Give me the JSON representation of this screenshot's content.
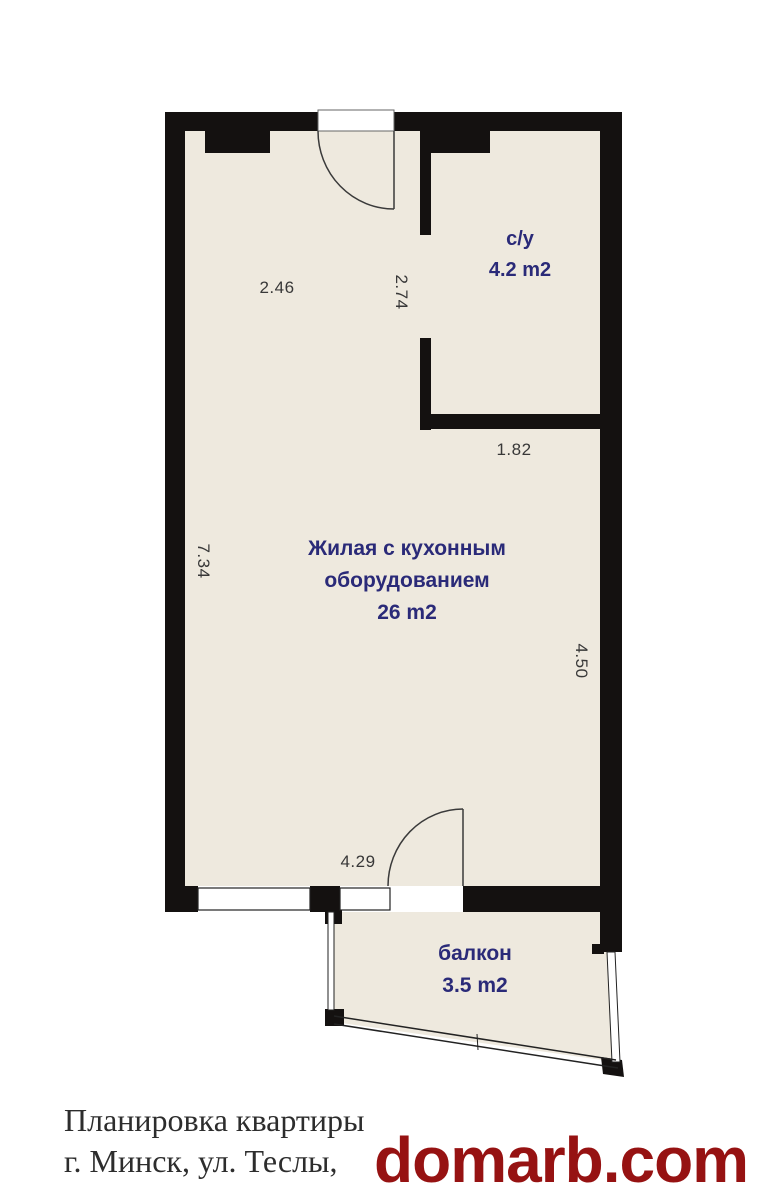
{
  "plan": {
    "rooms": {
      "bathroom": {
        "name": "с/у",
        "area": "4.2 m2"
      },
      "living": {
        "name_line1": "Жилая с кухонным",
        "name_line2": "оборудованием",
        "area": "26 m2"
      },
      "balcony": {
        "name": "балкон",
        "area": "3.5 m2"
      }
    },
    "dimensions": {
      "hall_width": "2.46",
      "hall_depth": "2.74",
      "bathroom_width": "1.82",
      "left_wall_height": "7.34",
      "right_wall_height": "4.50",
      "bottom_wall_width": "4.29"
    }
  },
  "caption": {
    "line1": "Планировка квартиры",
    "line2": "г. Минск, ул. Теслы,"
  },
  "watermark": {
    "text": "domarb.com"
  },
  "colors": {
    "wall": "#141110",
    "floor": "#eee9de",
    "room_label": "#2a2a78",
    "dimension_label": "#383838",
    "caption_text": "#2d2d2d",
    "watermark_red": "#961212",
    "window_white": "#ffffff"
  }
}
